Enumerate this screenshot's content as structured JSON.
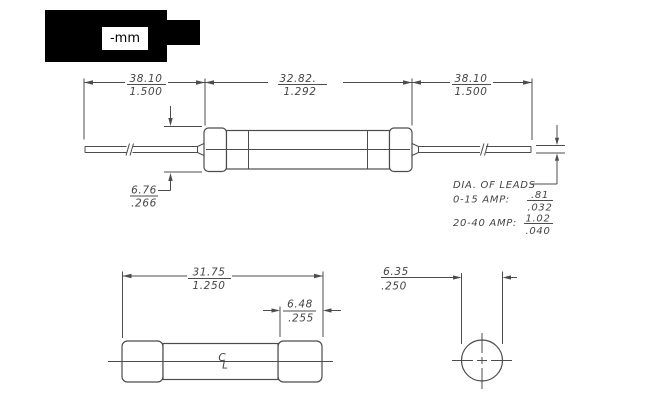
{
  "overlay": {
    "unit_label": "-mm"
  },
  "colors": {
    "line": "#4c4c4c",
    "text": "#454545",
    "redaction": "#000000",
    "background": "#ffffff"
  },
  "top_view": {
    "dim_lead_left": {
      "mm": "38.10",
      "inch": "1.500"
    },
    "dim_body": {
      "mm": "32.82.",
      "inch": "1.292"
    },
    "dim_lead_right": {
      "mm": "38.10",
      "inch": "1.500"
    },
    "dim_cap_dia": {
      "mm": "6.76",
      "inch": ".266"
    },
    "leads_note": {
      "title": "DIA. OF LEADS",
      "rows": [
        {
          "label": "0-15 AMP:",
          "mm": ".81",
          "inch": ".032"
        },
        {
          "label": "20-40 AMP:",
          "mm": "1.02",
          "inch": ".040"
        }
      ]
    }
  },
  "side_view": {
    "dim_length": {
      "mm": "31.75",
      "inch": "1.250"
    },
    "dim_cap": {
      "mm": "6.48",
      "inch": ".255"
    },
    "centerline_symbol": {
      "top": "C",
      "bottom": "L"
    }
  },
  "end_view": {
    "dim_dia": {
      "mm": "6.35",
      "inch": ".250"
    }
  }
}
